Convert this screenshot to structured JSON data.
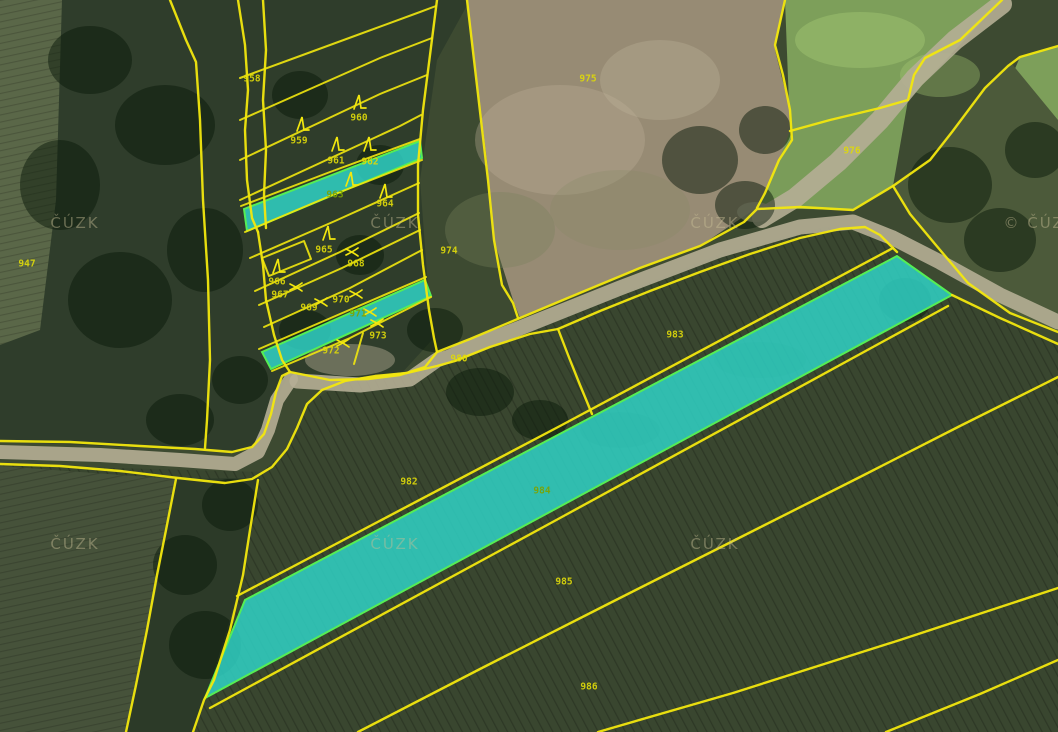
{
  "map": {
    "parcels": [
      {
        "number": "947",
        "highlighted": false
      },
      {
        "number": "958",
        "highlighted": false
      },
      {
        "number": "959",
        "highlighted": false
      },
      {
        "number": "960",
        "highlighted": false
      },
      {
        "number": "961",
        "highlighted": false
      },
      {
        "number": "962",
        "highlighted": false
      },
      {
        "number": "963",
        "highlighted": true
      },
      {
        "number": "964",
        "highlighted": false
      },
      {
        "number": "965",
        "highlighted": false
      },
      {
        "number": "966",
        "highlighted": false
      },
      {
        "number": "967",
        "highlighted": false
      },
      {
        "number": "968",
        "highlighted": false
      },
      {
        "number": "969",
        "highlighted": false
      },
      {
        "number": "970",
        "highlighted": false
      },
      {
        "number": "971",
        "highlighted": true
      },
      {
        "number": "972",
        "highlighted": false
      },
      {
        "number": "973",
        "highlighted": false
      },
      {
        "number": "974",
        "highlighted": false
      },
      {
        "number": "975",
        "highlighted": false
      },
      {
        "number": "976",
        "highlighted": false
      },
      {
        "number": "980",
        "highlighted": false
      },
      {
        "number": "982",
        "highlighted": false
      },
      {
        "number": "983",
        "highlighted": false
      },
      {
        "number": "984",
        "highlighted": true
      },
      {
        "number": "985",
        "highlighted": false
      },
      {
        "number": "986",
        "highlighted": false
      }
    ],
    "watermark": {
      "text": "ČÚZK",
      "copyright_text": "© ČÚZK"
    },
    "icons": {
      "tree_symbol_name": "tree-symbol",
      "scrub_symbol_name": "scrub-cross-symbol"
    },
    "colors": {
      "boundary_yellow": "#f2e70e",
      "highlight_fill": "#2fd8cc",
      "highlight_border": "#55ee55",
      "label_yellow": "#ded90a",
      "label_on_highlight": "#7da300",
      "watermark_gray": "#c8be96",
      "road_tan": "#b5ae95"
    }
  }
}
